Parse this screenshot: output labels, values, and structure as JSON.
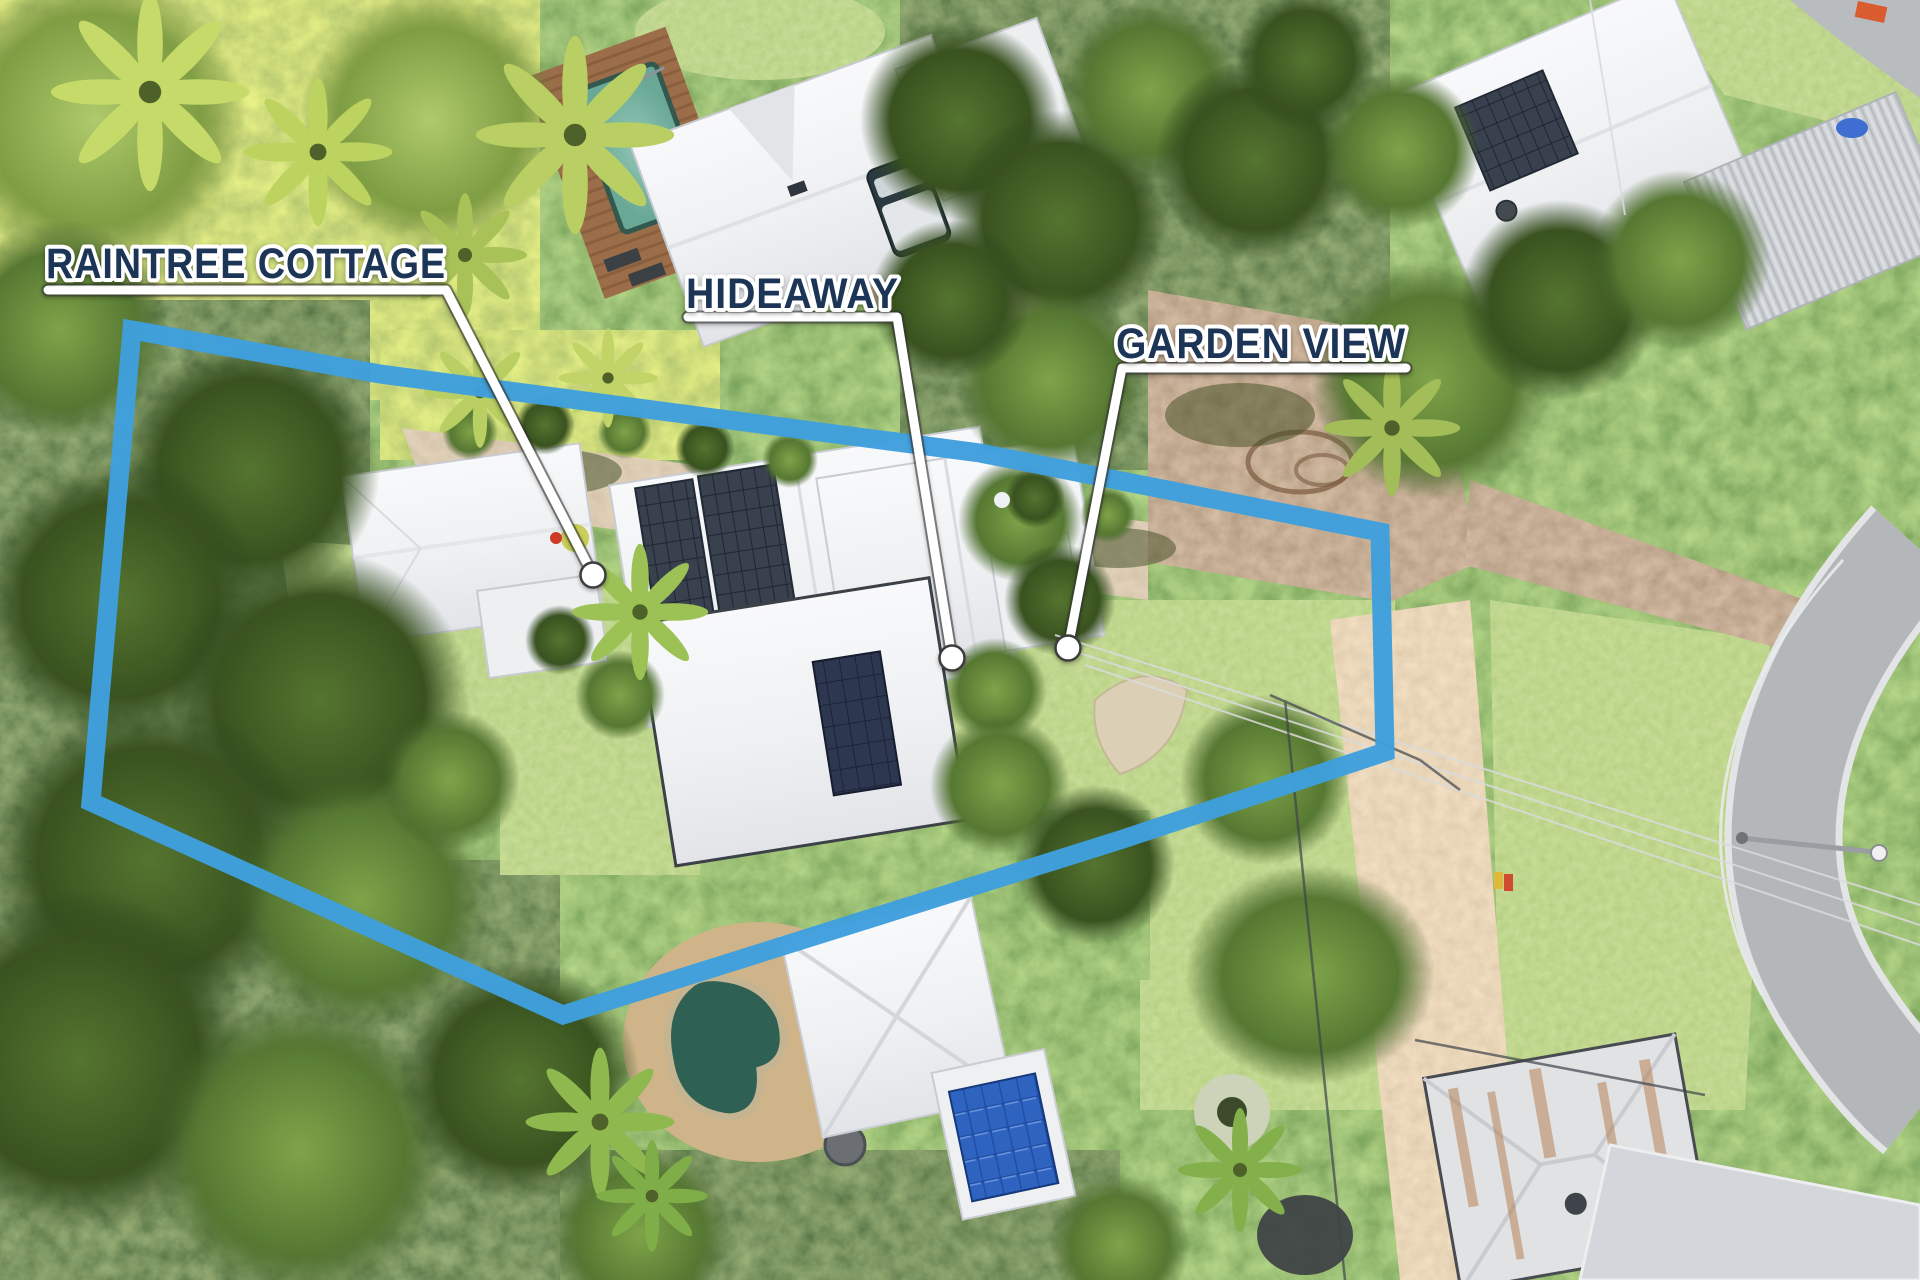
{
  "annotations": {
    "boundary_color": "#3f9fdd",
    "label_color": "#1d3557",
    "pointer_color": "#ffffff",
    "labels": [
      {
        "id": "raintree-cottage",
        "text": "RAINTREE COTTAGE"
      },
      {
        "id": "hideaway",
        "text": "HIDEAWAY"
      },
      {
        "id": "garden-view",
        "text": "GARDEN VIEW"
      }
    ]
  }
}
